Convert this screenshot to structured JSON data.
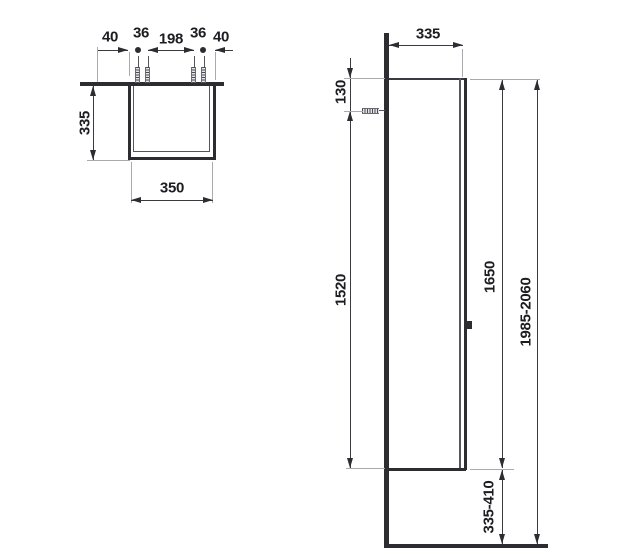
{
  "drawing": {
    "type": "technical-dimension-drawing",
    "colors": {
      "line": "#3a3a40",
      "thick_line": "#2c2c31",
      "extension_line": "#a9a9b0",
      "text": "#1c1c21",
      "background": "#ffffff"
    },
    "icons": {
      "mounting_screw": "hatched-screw-glyph"
    },
    "top_view": {
      "dims": {
        "offset_left": "40",
        "screw_gap_left": "36",
        "screw_span": "198",
        "screw_gap_right": "36",
        "offset_right": "40",
        "depth": "335",
        "width": "350"
      }
    },
    "side_view": {
      "dims": {
        "depth": "335",
        "top_to_screw": "130",
        "screw_to_base": "1520",
        "body_height": "1650",
        "total_height": "1985-2060",
        "base_clearance": "335-410"
      }
    }
  }
}
